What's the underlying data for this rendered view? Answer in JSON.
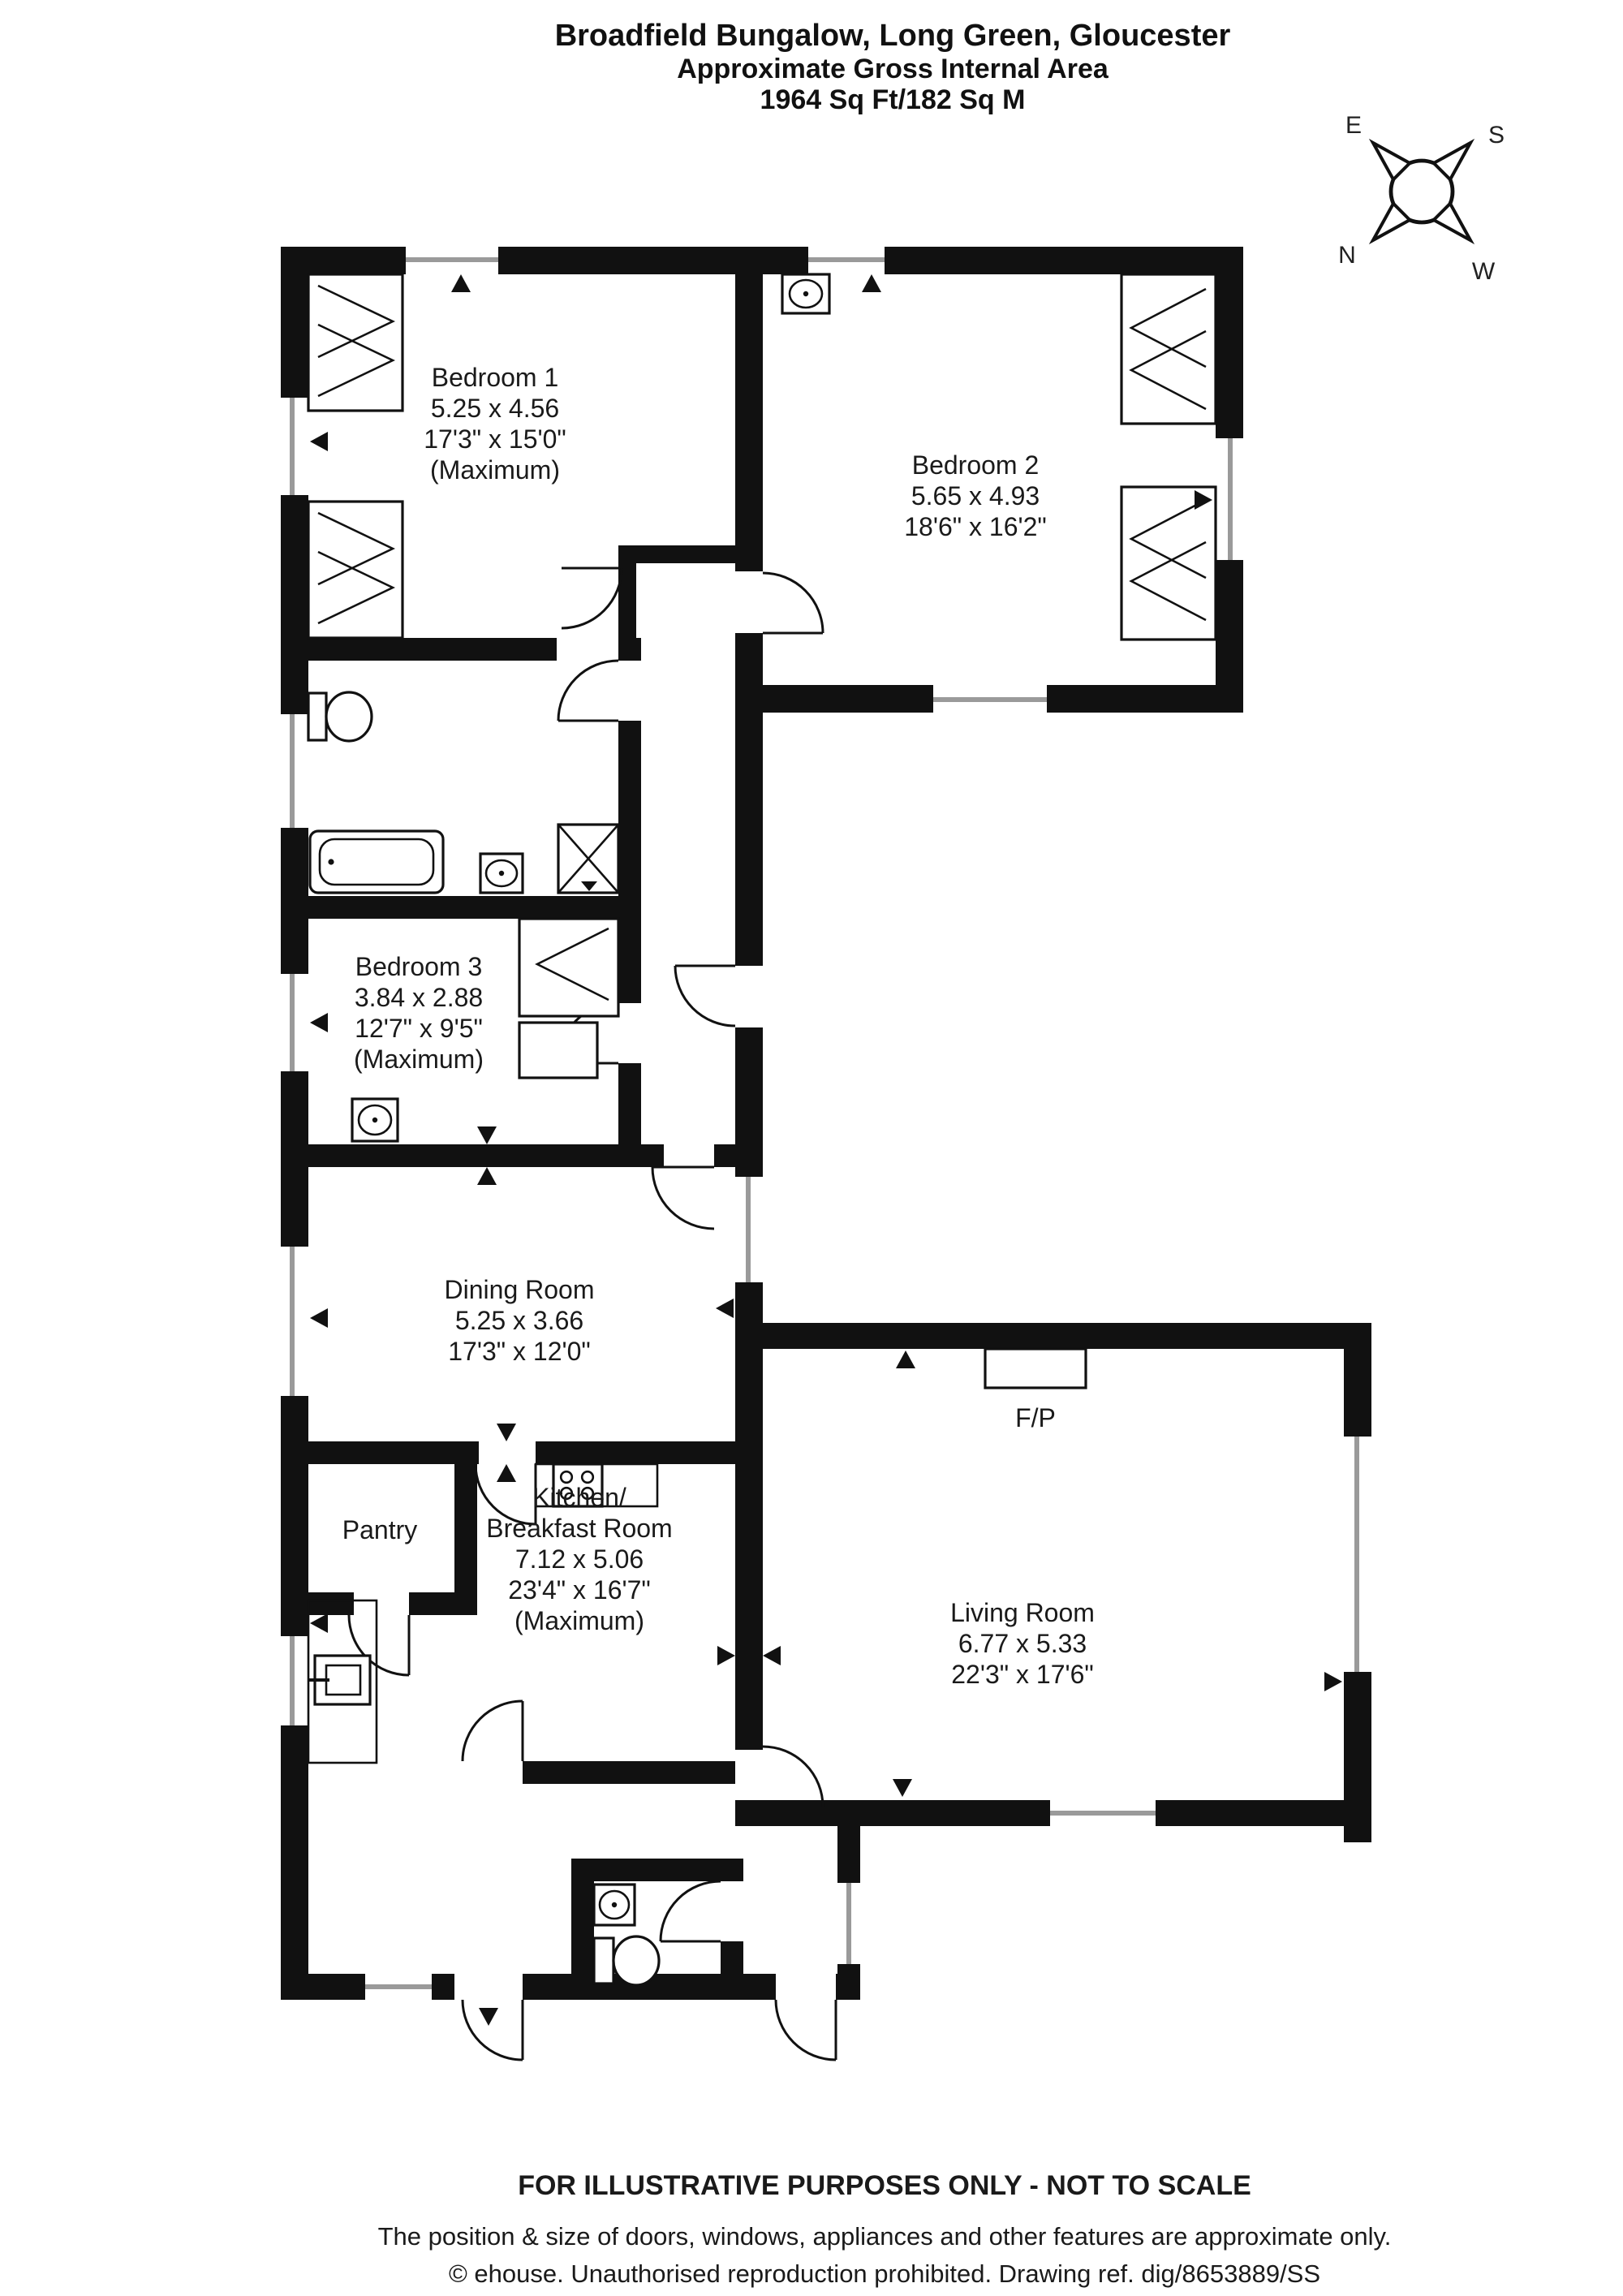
{
  "title": {
    "line1": "Broadfield Bungalow, Long Green, Gloucester",
    "line2": "Approximate Gross Internal Area",
    "line3": "1964 Sq Ft/182 Sq M"
  },
  "compass": {
    "n": "N",
    "e": "E",
    "s": "S",
    "w": "W"
  },
  "rooms": {
    "bedroom1": {
      "lines": [
        "Bedroom 1",
        "5.25 x 4.56",
        "17'3\" x 15'0\"",
        "(Maximum)"
      ]
    },
    "bedroom2": {
      "lines": [
        "Bedroom 2",
        "5.65 x 4.93",
        "18'6\" x 16'2\""
      ]
    },
    "bedroom3": {
      "lines": [
        "Bedroom 3",
        "3.84 x 2.88",
        "12'7\" x 9'5\"",
        "(Maximum)"
      ]
    },
    "dining": {
      "lines": [
        "Dining Room",
        "5.25 x 3.66",
        "17'3\" x 12'0\""
      ]
    },
    "living": {
      "lines": [
        "Living Room",
        "6.77 x 5.33",
        "22'3\" x 17'6\""
      ]
    },
    "kitchen": {
      "lines": [
        "Kitchen/",
        "Breakfast Room",
        "7.12 x 5.06",
        "23'4\" x 16'7\"",
        "(Maximum)"
      ]
    },
    "pantry": {
      "label": "Pantry"
    },
    "fireplace": {
      "label": "F/P"
    }
  },
  "footer": {
    "line1": "FOR ILLUSTRATIVE PURPOSES ONLY - NOT TO SCALE",
    "line2": "The position & size of doors, windows, appliances and other features are approximate only.",
    "line3": "© ehouse. Unauthorised reproduction prohibited. Drawing ref. dig/8653889/SS"
  },
  "colors": {
    "wall": "#111111",
    "glazing": "#9a9a9a",
    "text": "#1a1a1a"
  }
}
